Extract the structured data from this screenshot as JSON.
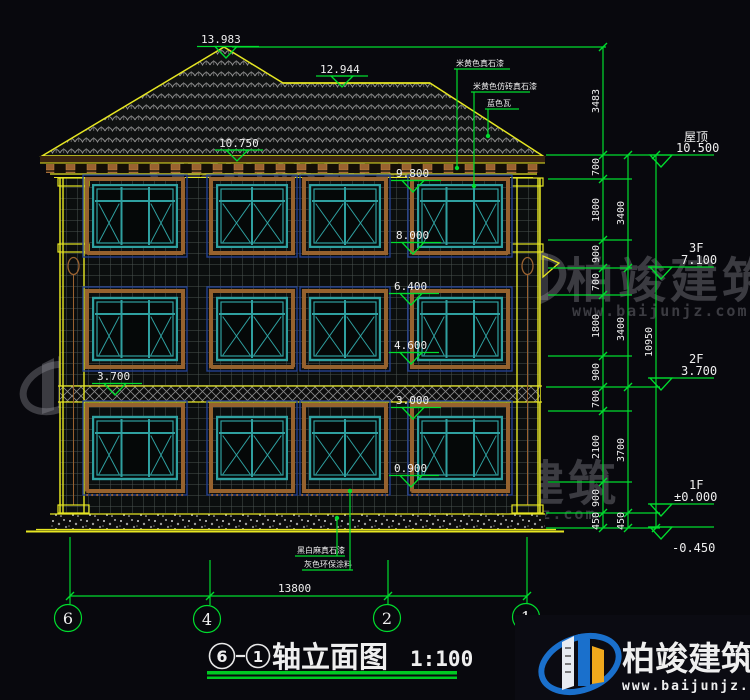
{
  "title_block": {
    "prefix_axis": "6",
    "suffix_axis": "1",
    "name": "轴立面图",
    "scale": "1:100"
  },
  "spot_elevations": {
    "peak": "13.983",
    "ridge": "12.944",
    "eave_left": "10.750",
    "v98": "9.800",
    "v80": "8.000",
    "v64": "6.400",
    "v46": "4.600",
    "v37_left": "3.700",
    "v30": "3.000",
    "v09": "0.900"
  },
  "level_markers": {
    "roof": {
      "label": "屋顶",
      "value": "10.500"
    },
    "f3": {
      "label": "3F",
      "value": "7.100"
    },
    "f2": {
      "label": "2F",
      "value": "3.700"
    },
    "f1": {
      "label": "1F",
      "value": "±0.000"
    },
    "base": {
      "value": "-0.450"
    }
  },
  "dims": {
    "inner": [
      "3483",
      "700",
      "1800",
      "900",
      "700",
      "1800",
      "900",
      "700",
      "2100",
      "900",
      "450"
    ],
    "middle": [
      "3400",
      "3400",
      "3700",
      "450"
    ],
    "overall_height": "10950",
    "overall_width": "13800"
  },
  "material_notes": {
    "roof": [
      "米黄色真石漆",
      "米黄色仿砖真石漆",
      "蓝色瓦"
    ],
    "base": [
      "黑白麻真石漆",
      "灰色环保涂料"
    ]
  },
  "grid_axes": [
    "6",
    "4",
    "2",
    "1"
  ],
  "watermark": {
    "brand": "柏竣建筑",
    "url": "www.baijunjz.com"
  },
  "logo": {
    "brand": "柏竣建筑",
    "url": "www.baijunjz.com"
  },
  "colors": {
    "line_green": "#00dc2e",
    "line_yellow": "#e6e622",
    "text_white": "#efefef",
    "window_teal": "#2fa0a0",
    "trim_brown": "#96622e",
    "frame_blue": "#23408f",
    "logo_blue": "#1a70cc",
    "logo_orange": "#f0a81c"
  }
}
